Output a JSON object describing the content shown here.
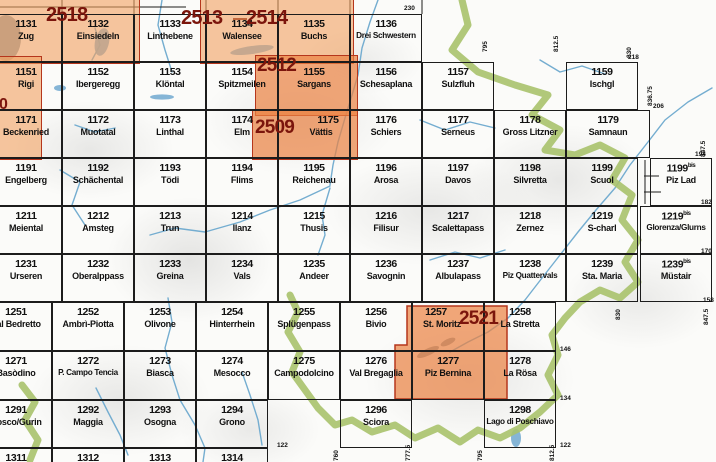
{
  "colors": {
    "orange_pale": "rgba(242,160,95,0.60)",
    "orange_strong": "rgba(235,130,65,0.70)",
    "red_border": "#b5361c",
    "label_red": "#7b150c",
    "grid_black": "#1c1c1c",
    "green_border_band": "#a8c26b",
    "river_blue": "#74add0",
    "lake_blue": "#85b5d6",
    "lake_gray": "#92a0ab"
  },
  "map_index": {
    "bis_suffix": "bis",
    "rows": [
      {
        "cells": [
          {
            "num": "1131",
            "name": "Zug",
            "x": -10,
            "y": 14,
            "w": 72,
            "h": 48
          },
          {
            "num": "1132",
            "name": "Einsiedeln",
            "x": 62,
            "y": 14,
            "w": 72,
            "h": 48
          },
          {
            "num": "1133",
            "name": "Linthebene",
            "x": 134,
            "y": 14,
            "w": 72,
            "h": 48
          },
          {
            "num": "1134",
            "name": "Walensee",
            "x": 206,
            "y": 14,
            "w": 72,
            "h": 48
          },
          {
            "num": "1135",
            "name": "Buchs",
            "x": 278,
            "y": 14,
            "w": 72,
            "h": 48
          },
          {
            "num": "1136",
            "name": "Drei Schwestern",
            "x": 350,
            "y": 14,
            "w": 72,
            "h": 48
          }
        ]
      },
      {
        "cells": [
          {
            "num": "1151",
            "name": "Rigi",
            "x": -10,
            "y": 62,
            "w": 72,
            "h": 48
          },
          {
            "num": "1152",
            "name": "Ibergeregg",
            "x": 62,
            "y": 62,
            "w": 72,
            "h": 48
          },
          {
            "num": "1153",
            "name": "Klöntal",
            "x": 134,
            "y": 62,
            "w": 72,
            "h": 48
          },
          {
            "num": "1154",
            "name": "Spitzmeilen",
            "x": 206,
            "y": 62,
            "w": 72,
            "h": 48
          },
          {
            "num": "1155",
            "name": "Sargans",
            "x": 278,
            "y": 62,
            "w": 72,
            "h": 48
          },
          {
            "num": "1156",
            "name": "Schesaplana",
            "x": 350,
            "y": 62,
            "w": 72,
            "h": 48
          },
          {
            "num": "1157",
            "name": "Sulzfluh",
            "x": 422,
            "y": 62,
            "w": 72,
            "h": 48
          },
          {
            "num": "1159",
            "name": "Ischgl",
            "x": 566,
            "y": 62,
            "w": 72,
            "h": 48
          }
        ]
      },
      {
        "cells": [
          {
            "num": "1171",
            "name": "Beckenried",
            "x": -10,
            "y": 110,
            "w": 72,
            "h": 48
          },
          {
            "num": "1172",
            "name": "Muotatal",
            "x": 62,
            "y": 110,
            "w": 72,
            "h": 48
          },
          {
            "num": "1173",
            "name": "Linthal",
            "x": 134,
            "y": 110,
            "w": 72,
            "h": 48
          },
          {
            "num": "1174",
            "name": "Elm",
            "x": 206,
            "y": 110,
            "w": 72,
            "h": 48
          },
          {
            "num": "1175",
            "name": "Vättis",
            "x": 278,
            "y": 110,
            "w": 72,
            "h": 48,
            "dx": 14
          },
          {
            "num": "1176",
            "name": "Schiers",
            "x": 350,
            "y": 110,
            "w": 72,
            "h": 48
          },
          {
            "num": "1177",
            "name": "Serneus",
            "x": 422,
            "y": 110,
            "w": 72,
            "h": 48
          },
          {
            "num": "1178",
            "name": "Gross Litzner",
            "x": 494,
            "y": 110,
            "w": 72,
            "h": 48
          },
          {
            "num": "1179",
            "name": "Samnaun",
            "x": 566,
            "y": 110,
            "w": 84,
            "h": 48
          }
        ]
      },
      {
        "cells": [
          {
            "num": "1191",
            "name": "Engelberg",
            "x": -10,
            "y": 158,
            "w": 72,
            "h": 48
          },
          {
            "num": "1192",
            "name": "Schächental",
            "x": 62,
            "y": 158,
            "w": 72,
            "h": 48
          },
          {
            "num": "1193",
            "name": "Tödi",
            "x": 134,
            "y": 158,
            "w": 72,
            "h": 48
          },
          {
            "num": "1194",
            "name": "Flims",
            "x": 206,
            "y": 158,
            "w": 72,
            "h": 48
          },
          {
            "num": "1195",
            "name": "Reichenau",
            "x": 278,
            "y": 158,
            "w": 72,
            "h": 48
          },
          {
            "num": "1196",
            "name": "Arosa",
            "x": 350,
            "y": 158,
            "w": 72,
            "h": 48
          },
          {
            "num": "1197",
            "name": "Davos",
            "x": 422,
            "y": 158,
            "w": 72,
            "h": 48
          },
          {
            "num": "1198",
            "name": "Silvretta",
            "x": 494,
            "y": 158,
            "w": 72,
            "h": 48
          },
          {
            "num": "1199",
            "name": "Scuol",
            "x": 566,
            "y": 158,
            "w": 72,
            "h": 48
          },
          {
            "num": "1199",
            "bis": true,
            "name": "Piz Lad",
            "x": 650,
            "y": 158,
            "w": 62,
            "h": 48
          }
        ]
      },
      {
        "cells": [
          {
            "num": "1211",
            "name": "Meiental",
            "x": -10,
            "y": 206,
            "w": 72,
            "h": 48
          },
          {
            "num": "1212",
            "name": "Amsteg",
            "x": 62,
            "y": 206,
            "w": 72,
            "h": 48
          },
          {
            "num": "1213",
            "name": "Trun",
            "x": 134,
            "y": 206,
            "w": 72,
            "h": 48
          },
          {
            "num": "1214",
            "name": "Ilanz",
            "x": 206,
            "y": 206,
            "w": 72,
            "h": 48
          },
          {
            "num": "1215",
            "name": "Thusis",
            "x": 278,
            "y": 206,
            "w": 72,
            "h": 48
          },
          {
            "num": "1216",
            "name": "Filisur",
            "x": 350,
            "y": 206,
            "w": 72,
            "h": 48
          },
          {
            "num": "1217",
            "name": "Scalettapass",
            "x": 422,
            "y": 206,
            "w": 72,
            "h": 48
          },
          {
            "num": "1218",
            "name": "Zernez",
            "x": 494,
            "y": 206,
            "w": 72,
            "h": 48
          },
          {
            "num": "1219",
            "name": "S-charl",
            "x": 566,
            "y": 206,
            "w": 72,
            "h": 48
          },
          {
            "num": "1219",
            "bis": true,
            "name": "Glorenza/Glurns",
            "x": 640,
            "y": 206,
            "w": 72,
            "h": 48
          }
        ]
      },
      {
        "cells": [
          {
            "num": "1231",
            "name": "Urseren",
            "x": -10,
            "y": 254,
            "w": 72,
            "h": 48
          },
          {
            "num": "1232",
            "name": "Oberalppass",
            "x": 62,
            "y": 254,
            "w": 72,
            "h": 48
          },
          {
            "num": "1233",
            "name": "Greina",
            "x": 134,
            "y": 254,
            "w": 72,
            "h": 48
          },
          {
            "num": "1234",
            "name": "Vals",
            "x": 206,
            "y": 254,
            "w": 72,
            "h": 48
          },
          {
            "num": "1235",
            "name": "Andeer",
            "x": 278,
            "y": 254,
            "w": 72,
            "h": 48
          },
          {
            "num": "1236",
            "name": "Savognin",
            "x": 350,
            "y": 254,
            "w": 72,
            "h": 48
          },
          {
            "num": "1237",
            "name": "Albulapass",
            "x": 422,
            "y": 254,
            "w": 72,
            "h": 48
          },
          {
            "num": "1238",
            "name": "Piz Quattervals",
            "x": 494,
            "y": 254,
            "w": 72,
            "h": 48
          },
          {
            "num": "1239",
            "name": "Sta. Maria",
            "x": 566,
            "y": 254,
            "w": 72,
            "h": 48
          },
          {
            "num": "1239",
            "bis": true,
            "name": "Müstair",
            "x": 640,
            "y": 254,
            "w": 72,
            "h": 48
          }
        ]
      },
      {
        "cells": [
          {
            "num": "1251",
            "name": "Val Bedretto",
            "x": -20,
            "y": 302,
            "w": 72,
            "h": 49
          },
          {
            "num": "1252",
            "name": "Ambrì-Piotta",
            "x": 52,
            "y": 302,
            "w": 72,
            "h": 49
          },
          {
            "num": "1253",
            "name": "Olivone",
            "x": 124,
            "y": 302,
            "w": 72,
            "h": 49
          },
          {
            "num": "1254",
            "name": "Hinterrhein",
            "x": 196,
            "y": 302,
            "w": 72,
            "h": 49
          },
          {
            "num": "1255",
            "name": "Splügenpass",
            "x": 268,
            "y": 302,
            "w": 72,
            "h": 49
          },
          {
            "num": "1256",
            "name": "Bivio",
            "x": 340,
            "y": 302,
            "w": 72,
            "h": 49
          },
          {
            "num": "1257",
            "name": "St. Moritz",
            "x": 412,
            "y": 302,
            "w": 72,
            "h": 49,
            "dx": -12
          },
          {
            "num": "1258",
            "name": "La Stretta",
            "x": 484,
            "y": 302,
            "w": 72,
            "h": 49
          }
        ]
      },
      {
        "cells": [
          {
            "num": "1271",
            "name": "Basòdino",
            "x": -20,
            "y": 351,
            "w": 72,
            "h": 49
          },
          {
            "num": "1272",
            "name": "P. Campo Tencia",
            "x": 52,
            "y": 351,
            "w": 72,
            "h": 49
          },
          {
            "num": "1273",
            "name": "Biasca",
            "x": 124,
            "y": 351,
            "w": 72,
            "h": 49
          },
          {
            "num": "1274",
            "name": "Mesocco",
            "x": 196,
            "y": 351,
            "w": 72,
            "h": 49
          },
          {
            "num": "1275",
            "name": "Campodolcino",
            "x": 268,
            "y": 351,
            "w": 72,
            "h": 49
          },
          {
            "num": "1276",
            "name": "Val Bregaglia",
            "x": 340,
            "y": 351,
            "w": 72,
            "h": 49
          },
          {
            "num": "1277",
            "name": "Piz Bernina",
            "x": 412,
            "y": 351,
            "w": 72,
            "h": 49
          },
          {
            "num": "1278",
            "name": "La Rösa",
            "x": 484,
            "y": 351,
            "w": 72,
            "h": 49
          }
        ]
      },
      {
        "cells": [
          {
            "num": "1291",
            "name": "Bosco/Gurin",
            "x": -20,
            "y": 400,
            "w": 72,
            "h": 48
          },
          {
            "num": "1292",
            "name": "Maggia",
            "x": 52,
            "y": 400,
            "w": 72,
            "h": 48
          },
          {
            "num": "1293",
            "name": "Osogna",
            "x": 124,
            "y": 400,
            "w": 72,
            "h": 48
          },
          {
            "num": "1294",
            "name": "Grono",
            "x": 196,
            "y": 400,
            "w": 72,
            "h": 48
          },
          {
            "num": "1296",
            "name": "Sciora",
            "x": 340,
            "y": 400,
            "w": 72,
            "h": 48
          },
          {
            "num": "1298",
            "name": "Lago di Poschiavo",
            "x": 484,
            "y": 400,
            "w": 72,
            "h": 48
          }
        ]
      },
      {
        "cells": [
          {
            "num": "1311",
            "name": "",
            "x": -20,
            "y": 448,
            "w": 72,
            "h": 14,
            "partial": true
          },
          {
            "num": "1312",
            "name": "",
            "x": 52,
            "y": 448,
            "w": 72,
            "h": 14,
            "partial": true
          },
          {
            "num": "1313",
            "name": "",
            "x": 124,
            "y": 448,
            "w": 72,
            "h": 14,
            "partial": true
          },
          {
            "num": "1314",
            "name": "",
            "x": 196,
            "y": 448,
            "w": 72,
            "h": 14,
            "partial": true
          }
        ]
      }
    ],
    "composite_sheets": {
      "labels": [
        {
          "text": "2518",
          "x": 46,
          "y": 5,
          "size": 20
        },
        {
          "text": "2513",
          "x": 181,
          "y": 8,
          "size": 20
        },
        {
          "text": "2514",
          "x": 246,
          "y": 8,
          "size": 20
        },
        {
          "text": "2512",
          "x": 257,
          "y": 56,
          "size": 19
        },
        {
          "text": "2509",
          "x": 255,
          "y": 118,
          "size": 19
        },
        {
          "text": "2521",
          "x": 459,
          "y": 309,
          "size": 19
        },
        {
          "text": "0",
          "x": -1,
          "y": 97,
          "size": 16
        }
      ],
      "overlays_pale": [
        {
          "x": -14,
          "y": -8,
          "w": 152,
          "h": 70
        },
        {
          "x": 200,
          "y": -8,
          "w": 152,
          "h": 70
        },
        {
          "x": -14,
          "y": 56,
          "w": 54,
          "h": 102
        }
      ],
      "overlays_strong": [
        {
          "x": 255,
          "y": 55,
          "w": 101,
          "h": 59
        },
        {
          "x": 252,
          "y": 109,
          "w": 104,
          "h": 49
        }
      ],
      "polygon_2521": "407,306 507,306 507,399 395,399 395,345 407,345"
    },
    "edge_labels_horizontal": [
      {
        "text": "230",
        "x": 404,
        "y": 6
      },
      {
        "text": "218",
        "x": 628,
        "y": 55
      },
      {
        "text": "206",
        "x": 653,
        "y": 104
      },
      {
        "text": "194",
        "x": 695,
        "y": 152
      },
      {
        "text": "182",
        "x": 701,
        "y": 200
      },
      {
        "text": "170",
        "x": 701,
        "y": 249
      },
      {
        "text": "158",
        "x": 703,
        "y": 298
      },
      {
        "text": "146",
        "x": 560,
        "y": 347
      },
      {
        "text": "134",
        "x": 560,
        "y": 396
      },
      {
        "text": "122",
        "x": 560,
        "y": 443
      },
      {
        "text": "122",
        "x": 277,
        "y": 443
      }
    ],
    "edge_labels_vertical": [
      {
        "text": "795",
        "x": 483,
        "y": 52
      },
      {
        "text": "812.5",
        "x": 554,
        "y": 52
      },
      {
        "text": "830",
        "x": 627,
        "y": 58
      },
      {
        "text": "836.75",
        "x": 648,
        "y": 106
      },
      {
        "text": "847.5",
        "x": 701,
        "y": 157
      },
      {
        "text": "830",
        "x": 616,
        "y": 320
      },
      {
        "text": "847.5",
        "x": 704,
        "y": 325
      },
      {
        "text": "760",
        "x": 334,
        "y": 461
      },
      {
        "text": "777.5",
        "x": 406,
        "y": 461
      },
      {
        "text": "795",
        "x": 478,
        "y": 461
      },
      {
        "text": "812.5",
        "x": 550,
        "y": 461
      }
    ]
  }
}
